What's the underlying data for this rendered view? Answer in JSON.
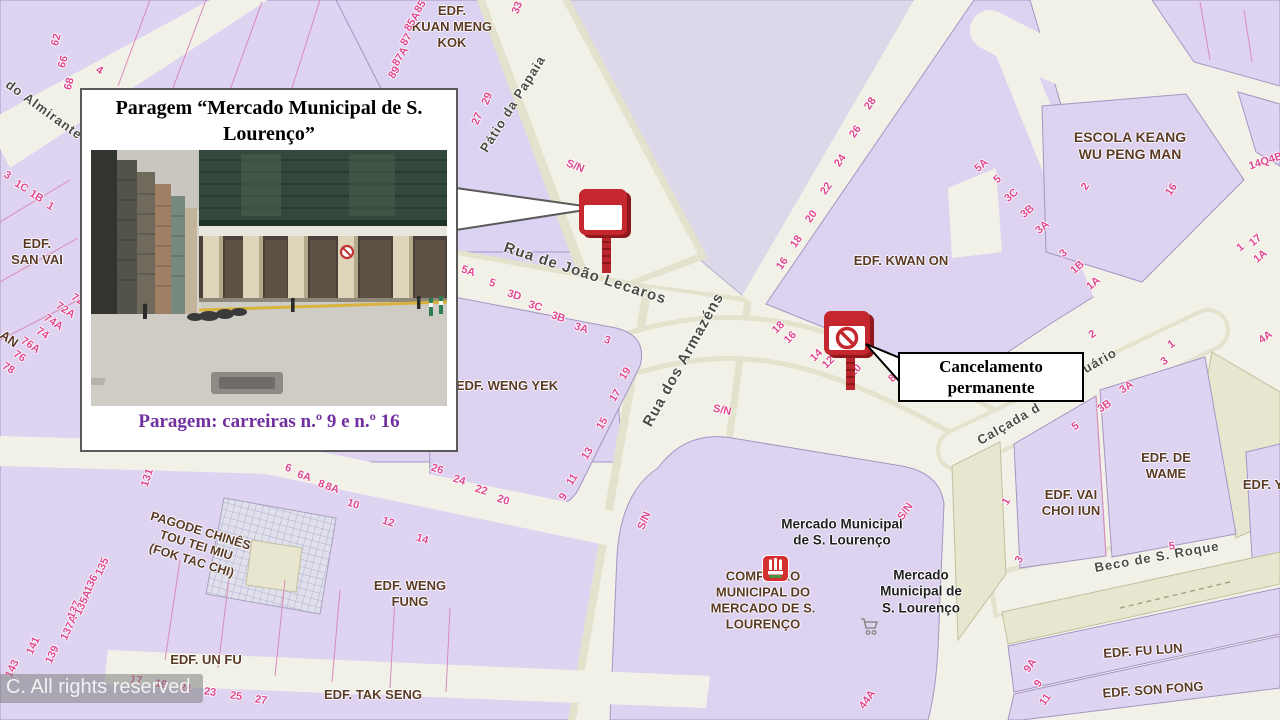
{
  "callout": {
    "title": "Paragem “Mercado Municipal  de S. Lourenço”",
    "caption": "Paragem: carreiras  n.º 9 e n.º 16"
  },
  "annotation": {
    "text": "Cancelamento permanente"
  },
  "watermark": "C. All rights reserved",
  "colors": {
    "block_fill": "#ded4f2",
    "block_outline": "#a694c2",
    "street_fill": "#f2f1e8",
    "street_shade": "#e3e2cc",
    "olive_block": "#e8e6cf",
    "plaza_fill": "#dcd8ea",
    "number_pink": "#e0488e",
    "building_label": "#5b3a25",
    "street_label": "#4c4c45",
    "callout_accent": "#7030a0",
    "sign_red": "#c4282e",
    "sign_red_dark": "#8f181d"
  },
  "markers": {
    "bus_stop": {
      "icon": "bus-stop-sign-icon",
      "x": 577,
      "y": 183
    },
    "bus_stop_cancelled": {
      "icon": "bus-stop-cancelled-sign-icon",
      "x": 822,
      "y": 306
    },
    "market_poi": {
      "icon": "municipal-market-icon",
      "x": 762,
      "y": 555
    },
    "cart_poi": {
      "icon": "shopping-cart-icon",
      "x": 859,
      "y": 617
    }
  },
  "map": {
    "buildings": [
      {
        "lines": [
          "EDF.",
          "KUAN MENG",
          "KOK"
        ],
        "x": 452,
        "y": 27
      },
      {
        "lines": [
          "ESCOLA KEANG",
          "WU PENG MAN"
        ],
        "x": 1130,
        "y": 146,
        "s": 14
      },
      {
        "lines": [
          "EDF. KWAN ON"
        ],
        "x": 901,
        "y": 261
      },
      {
        "lines": [
          "EDF.",
          "SAN VAI"
        ],
        "x": 37,
        "y": 252
      },
      {
        "lines": [
          "EDF. WENG YEK"
        ],
        "x": 507,
        "y": 386
      },
      {
        "lines": [
          "EDF. WENG",
          "FUNG"
        ],
        "x": 410,
        "y": 594
      },
      {
        "lines": [
          "EDF. UN FU"
        ],
        "x": 206,
        "y": 660
      },
      {
        "lines": [
          "EDF. TAK SENG"
        ],
        "x": 373,
        "y": 695
      },
      {
        "lines": [
          "PAGODE CHINÊS",
          "TOU TEI MIU",
          "(FOK TAC CHI)"
        ],
        "x": 196,
        "y": 546,
        "r": 17,
        "s": 12.5
      },
      {
        "lines": [
          "COMPLEXO",
          "MUNICIPAL DO",
          "MERCADO DE S.",
          "LOURENÇO"
        ],
        "x": 763,
        "y": 600
      },
      {
        "lines": [
          "EDF. DE",
          "WAME"
        ],
        "x": 1166,
        "y": 466
      },
      {
        "lines": [
          "EDF. VAI",
          "CHOI IUN"
        ],
        "x": 1071,
        "y": 503
      },
      {
        "lines": [
          "EDF. FU LUN"
        ],
        "x": 1143,
        "y": 651,
        "r": -4
      },
      {
        "lines": [
          "EDF. SON FONG"
        ],
        "x": 1153,
        "y": 690,
        "r": -4
      },
      {
        "lines": [
          "EDF. Y"
        ],
        "x": 1263,
        "y": 485
      },
      {
        "lines": [
          "AN"
        ],
        "x": 9,
        "y": 339,
        "r": 35
      }
    ],
    "pois": [
      {
        "lines": [
          "Mercado Municipal",
          "de S. Lourenço"
        ],
        "x": 842,
        "y": 533
      },
      {
        "lines": [
          "Mercado",
          "Municipal de",
          "S. Lourenço"
        ],
        "x": 921,
        "y": 592
      }
    ],
    "streets": [
      {
        "t": "do Almirante",
        "x": 44,
        "y": 110,
        "r": 36
      },
      {
        "t": "Pátio da Papaia",
        "x": 513,
        "y": 104,
        "r": -58
      },
      {
        "t": "Rua de João Lecaros",
        "x": 585,
        "y": 274,
        "r": 18,
        "s": 15
      },
      {
        "t": "Rua dos Armazéns",
        "x": 684,
        "y": 360,
        "r": -61,
        "s": 15
      },
      {
        "t": "Calçada d",
        "x": 1009,
        "y": 424,
        "r": -30
      },
      {
        "t": "nuário",
        "x": 1096,
        "y": 363,
        "r": -30
      },
      {
        "t": "Beco de S. Roque",
        "x": 1157,
        "y": 557,
        "r": -10
      }
    ],
    "numbers": [
      {
        "t": "62",
        "x": 57,
        "y": 40,
        "r": -75
      },
      {
        "t": "66",
        "x": 64,
        "y": 62,
        "r": -75
      },
      {
        "t": "68",
        "x": 70,
        "y": 84,
        "r": -75
      },
      {
        "t": "4",
        "x": 99,
        "y": 71,
        "r": 30
      },
      {
        "t": "85",
        "x": 421,
        "y": 7,
        "r": -58
      },
      {
        "t": "85A",
        "x": 413,
        "y": 22,
        "r": -58
      },
      {
        "t": "87",
        "x": 407,
        "y": 40,
        "r": -58
      },
      {
        "t": "87A",
        "x": 401,
        "y": 57,
        "r": -58
      },
      {
        "t": "89",
        "x": 395,
        "y": 73,
        "r": -58
      },
      {
        "t": "33",
        "x": 518,
        "y": 8,
        "r": -68
      },
      {
        "t": "29",
        "x": 488,
        "y": 99,
        "r": -68
      },
      {
        "t": "27",
        "x": 478,
        "y": 119,
        "r": -68
      },
      {
        "t": "5A",
        "x": 468,
        "y": 272,
        "r": 18
      },
      {
        "t": "5",
        "x": 492,
        "y": 284,
        "r": 18
      },
      {
        "t": "3D",
        "x": 514,
        "y": 296,
        "r": 18
      },
      {
        "t": "3C",
        "x": 535,
        "y": 307,
        "r": 18
      },
      {
        "t": "3B",
        "x": 558,
        "y": 318,
        "r": 18
      },
      {
        "t": "3A",
        "x": 581,
        "y": 329,
        "r": 18
      },
      {
        "t": "3",
        "x": 607,
        "y": 341,
        "r": 18
      },
      {
        "t": "19",
        "x": 626,
        "y": 374,
        "r": -58
      },
      {
        "t": "17",
        "x": 616,
        "y": 396,
        "r": -58
      },
      {
        "t": "15",
        "x": 603,
        "y": 424,
        "r": -58
      },
      {
        "t": "13",
        "x": 588,
        "y": 454,
        "r": -58
      },
      {
        "t": "11",
        "x": 573,
        "y": 480,
        "r": -58
      },
      {
        "t": "9",
        "x": 564,
        "y": 497,
        "r": -58
      },
      {
        "t": "26",
        "x": 437,
        "y": 470,
        "r": 17
      },
      {
        "t": "24",
        "x": 459,
        "y": 481,
        "r": 17
      },
      {
        "t": "22",
        "x": 481,
        "y": 491,
        "r": 17
      },
      {
        "t": "20",
        "x": 503,
        "y": 501,
        "r": 17
      },
      {
        "t": "6",
        "x": 288,
        "y": 469,
        "r": 18
      },
      {
        "t": "6A",
        "x": 304,
        "y": 477,
        "r": 18
      },
      {
        "t": "8",
        "x": 321,
        "y": 485,
        "r": 18
      },
      {
        "t": "8A",
        "x": 332,
        "y": 489,
        "r": 18
      },
      {
        "t": "10",
        "x": 353,
        "y": 505,
        "r": 18
      },
      {
        "t": "12",
        "x": 388,
        "y": 523,
        "r": 18
      },
      {
        "t": "14",
        "x": 422,
        "y": 540,
        "r": 18
      },
      {
        "t": "131",
        "x": 148,
        "y": 478,
        "r": -72
      },
      {
        "t": "143",
        "x": 13,
        "y": 669,
        "r": -65
      },
      {
        "t": "141",
        "x": 34,
        "y": 646,
        "r": -65
      },
      {
        "t": "139",
        "x": 53,
        "y": 655,
        "r": -65
      },
      {
        "t": "137A",
        "x": 70,
        "y": 628,
        "r": -65
      },
      {
        "t": "137",
        "x": 75,
        "y": 610,
        "r": -65
      },
      {
        "t": "136",
        "x": 92,
        "y": 584,
        "r": -65
      },
      {
        "t": "135A",
        "x": 84,
        "y": 603,
        "r": -65
      },
      {
        "t": "135",
        "x": 103,
        "y": 567,
        "r": -65
      },
      {
        "t": "17",
        "x": 136,
        "y": 681,
        "r": 8
      },
      {
        "t": "19",
        "x": 161,
        "y": 685,
        "r": 8
      },
      {
        "t": "21",
        "x": 186,
        "y": 689,
        "r": 8
      },
      {
        "t": "23",
        "x": 210,
        "y": 693,
        "r": 8
      },
      {
        "t": "25",
        "x": 236,
        "y": 697,
        "r": 8
      },
      {
        "t": "27",
        "x": 261,
        "y": 701,
        "r": 8
      },
      {
        "t": "16",
        "x": 783,
        "y": 264,
        "r": -55
      },
      {
        "t": "18",
        "x": 797,
        "y": 242,
        "r": -55
      },
      {
        "t": "20",
        "x": 812,
        "y": 217,
        "r": -55
      },
      {
        "t": "22",
        "x": 827,
        "y": 189,
        "r": -55
      },
      {
        "t": "24",
        "x": 841,
        "y": 161,
        "r": -55
      },
      {
        "t": "26",
        "x": 856,
        "y": 132,
        "r": -55
      },
      {
        "t": "28",
        "x": 871,
        "y": 104,
        "r": -55
      },
      {
        "t": "2",
        "x": 1086,
        "y": 187,
        "r": -55
      },
      {
        "t": "16",
        "x": 1172,
        "y": 190,
        "r": -55
      },
      {
        "t": "5A",
        "x": 982,
        "y": 166,
        "r": -42
      },
      {
        "t": "5",
        "x": 998,
        "y": 180,
        "r": -42
      },
      {
        "t": "3C",
        "x": 1012,
        "y": 196,
        "r": -42
      },
      {
        "t": "3B",
        "x": 1028,
        "y": 212,
        "r": -42
      },
      {
        "t": "3A",
        "x": 1043,
        "y": 228,
        "r": -42
      },
      {
        "t": "3",
        "x": 1064,
        "y": 254,
        "r": -42
      },
      {
        "t": "1B",
        "x": 1078,
        "y": 268,
        "r": -42
      },
      {
        "t": "1A",
        "x": 1094,
        "y": 284,
        "r": -42
      },
      {
        "t": "14Q4B",
        "x": 1266,
        "y": 162,
        "r": -18
      },
      {
        "t": "17",
        "x": 1256,
        "y": 241,
        "r": -40
      },
      {
        "t": "1",
        "x": 1241,
        "y": 248,
        "r": -40
      },
      {
        "t": "1A",
        "x": 1261,
        "y": 257,
        "r": -40
      },
      {
        "t": "18",
        "x": 779,
        "y": 328,
        "r": -45
      },
      {
        "t": "16",
        "x": 791,
        "y": 338,
        "r": -45
      },
      {
        "t": "14",
        "x": 817,
        "y": 356,
        "r": -45
      },
      {
        "t": "12",
        "x": 829,
        "y": 363,
        "r": -45
      },
      {
        "t": "10",
        "x": 856,
        "y": 371,
        "r": -45
      },
      {
        "t": "8",
        "x": 893,
        "y": 379,
        "r": -45
      },
      {
        "t": "2",
        "x": 1093,
        "y": 335,
        "r": -35
      },
      {
        "t": "1",
        "x": 1172,
        "y": 345,
        "r": -35
      },
      {
        "t": "3",
        "x": 1165,
        "y": 362,
        "r": -35
      },
      {
        "t": "3A",
        "x": 1127,
        "y": 388,
        "r": -35
      },
      {
        "t": "3B",
        "x": 1105,
        "y": 407,
        "r": -35
      },
      {
        "t": "5",
        "x": 1076,
        "y": 427,
        "r": -35
      },
      {
        "t": "4A",
        "x": 1266,
        "y": 338,
        "r": -35
      },
      {
        "t": "1",
        "x": 1007,
        "y": 502,
        "r": -60
      },
      {
        "t": "3",
        "x": 1020,
        "y": 560,
        "r": -60
      },
      {
        "t": "5",
        "x": 1172,
        "y": 547,
        "r": -8
      },
      {
        "t": "S/N",
        "x": 575,
        "y": 167,
        "r": 22
      },
      {
        "t": "S/N",
        "x": 722,
        "y": 411,
        "r": 12
      },
      {
        "t": "S/N",
        "x": 645,
        "y": 521,
        "r": -68
      },
      {
        "t": "S/N",
        "x": 906,
        "y": 512,
        "r": -55
      },
      {
        "t": "9A",
        "x": 1031,
        "y": 666,
        "r": -55
      },
      {
        "t": "9",
        "x": 1039,
        "y": 684,
        "r": -55
      },
      {
        "t": "11",
        "x": 1046,
        "y": 700,
        "r": -55
      },
      {
        "t": "44A",
        "x": 868,
        "y": 700,
        "r": -55
      },
      {
        "t": "3",
        "x": 7,
        "y": 176,
        "r": 32
      },
      {
        "t": "1C",
        "x": 21,
        "y": 187,
        "r": 32
      },
      {
        "t": "1B",
        "x": 36,
        "y": 197,
        "r": 32
      },
      {
        "t": "1",
        "x": 50,
        "y": 207,
        "r": 32
      },
      {
        "t": "78",
        "x": 8,
        "y": 369,
        "r": 33
      },
      {
        "t": "76",
        "x": 19,
        "y": 357,
        "r": 33
      },
      {
        "t": "76A",
        "x": 30,
        "y": 346,
        "r": 33
      },
      {
        "t": "74",
        "x": 42,
        "y": 334,
        "r": 33
      },
      {
        "t": "74A",
        "x": 53,
        "y": 323,
        "r": 33
      },
      {
        "t": "72A",
        "x": 65,
        "y": 311,
        "r": 33
      },
      {
        "t": "72",
        "x": 77,
        "y": 300,
        "r": 33
      }
    ]
  }
}
